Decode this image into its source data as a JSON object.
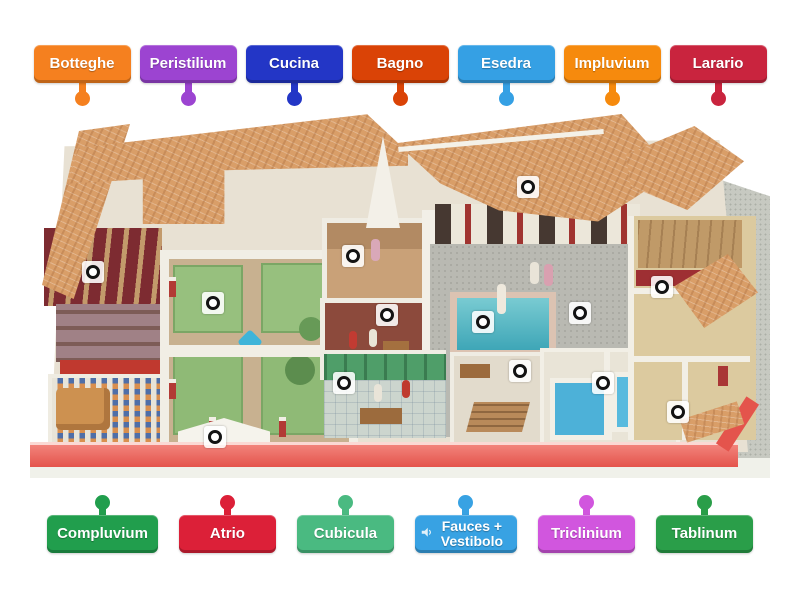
{
  "activity": {
    "top_labels": [
      {
        "label": "Botteghe",
        "color": "#f5801f"
      },
      {
        "label": "Peristilium",
        "color": "#9c44d1"
      },
      {
        "label": "Cucina",
        "color": "#2336c6"
      },
      {
        "label": "Bagno",
        "color": "#da4306"
      },
      {
        "label": "Esedra",
        "color": "#35a0e4"
      },
      {
        "label": "Impluvium",
        "color": "#f68a0d"
      },
      {
        "label": "Larario",
        "color": "#c9243e"
      }
    ],
    "bottom_labels": [
      {
        "label": "Compluvium",
        "color": "#219e4d"
      },
      {
        "label": "Atrio",
        "color": "#dc2038"
      },
      {
        "label": "Cubicula",
        "color": "#4aba81"
      },
      {
        "label": "Fauces + Vestibolo",
        "color": "#38a2e3",
        "audio_icon": "speaker"
      },
      {
        "label": "Triclinium",
        "color": "#d156de"
      },
      {
        "label": "Tablinum",
        "color": "#2a9e49"
      }
    ],
    "pins": [
      {
        "x": 63,
        "y": 160
      },
      {
        "x": 183,
        "y": 191
      },
      {
        "x": 323,
        "y": 144
      },
      {
        "x": 357,
        "y": 203
      },
      {
        "x": 314,
        "y": 271
      },
      {
        "x": 185,
        "y": 325
      },
      {
        "x": 498,
        "y": 75
      },
      {
        "x": 453,
        "y": 210
      },
      {
        "x": 550,
        "y": 201
      },
      {
        "x": 632,
        "y": 175
      },
      {
        "x": 490,
        "y": 259
      },
      {
        "x": 573,
        "y": 271
      },
      {
        "x": 648,
        "y": 300
      }
    ],
    "pin_style": {
      "ring_color": "#131313",
      "fill": "#ffffff"
    },
    "scene_colors": {
      "roof_tile": "#d99e68",
      "podium_red": "#e4544c",
      "pool_blue": "#4db1d8",
      "garden_green": "#97c07e",
      "wall_white": "#f1eee5",
      "pavement_gray": "#c7c9c1"
    }
  }
}
